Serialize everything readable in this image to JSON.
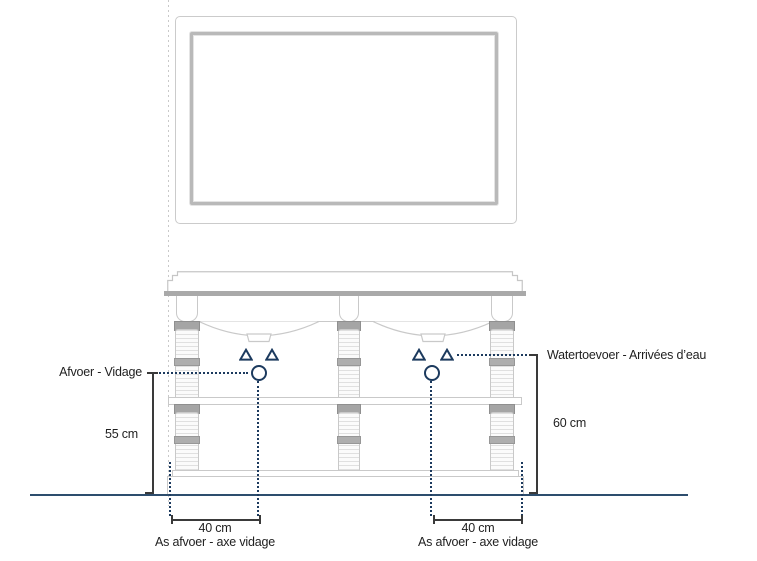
{
  "annotations": {
    "drain_label": "Afvoer - Vidage",
    "supply_label": "Watertoevoer - Arrivées d’eau",
    "drain_height": "55 cm",
    "supply_height": "60 cm",
    "left_offset": {
      "value": "40 cm",
      "caption": "As afvoer - axe vidage"
    },
    "right_offset": {
      "value": "40 cm",
      "caption": "As afvoer - axe vidage"
    }
  },
  "symbols": {
    "water_supply_marker": "outlined triangle",
    "drain_marker": "outlined circle"
  },
  "colors": {
    "marker_navy": "#1c3a5e",
    "floor_navy": "#2d4d6d",
    "counter_edge_gray": "#a9a9a9",
    "outline_gray": "#c9c9c9",
    "dimension_black": "#3a3a3a",
    "text": "#1f1f1f"
  }
}
